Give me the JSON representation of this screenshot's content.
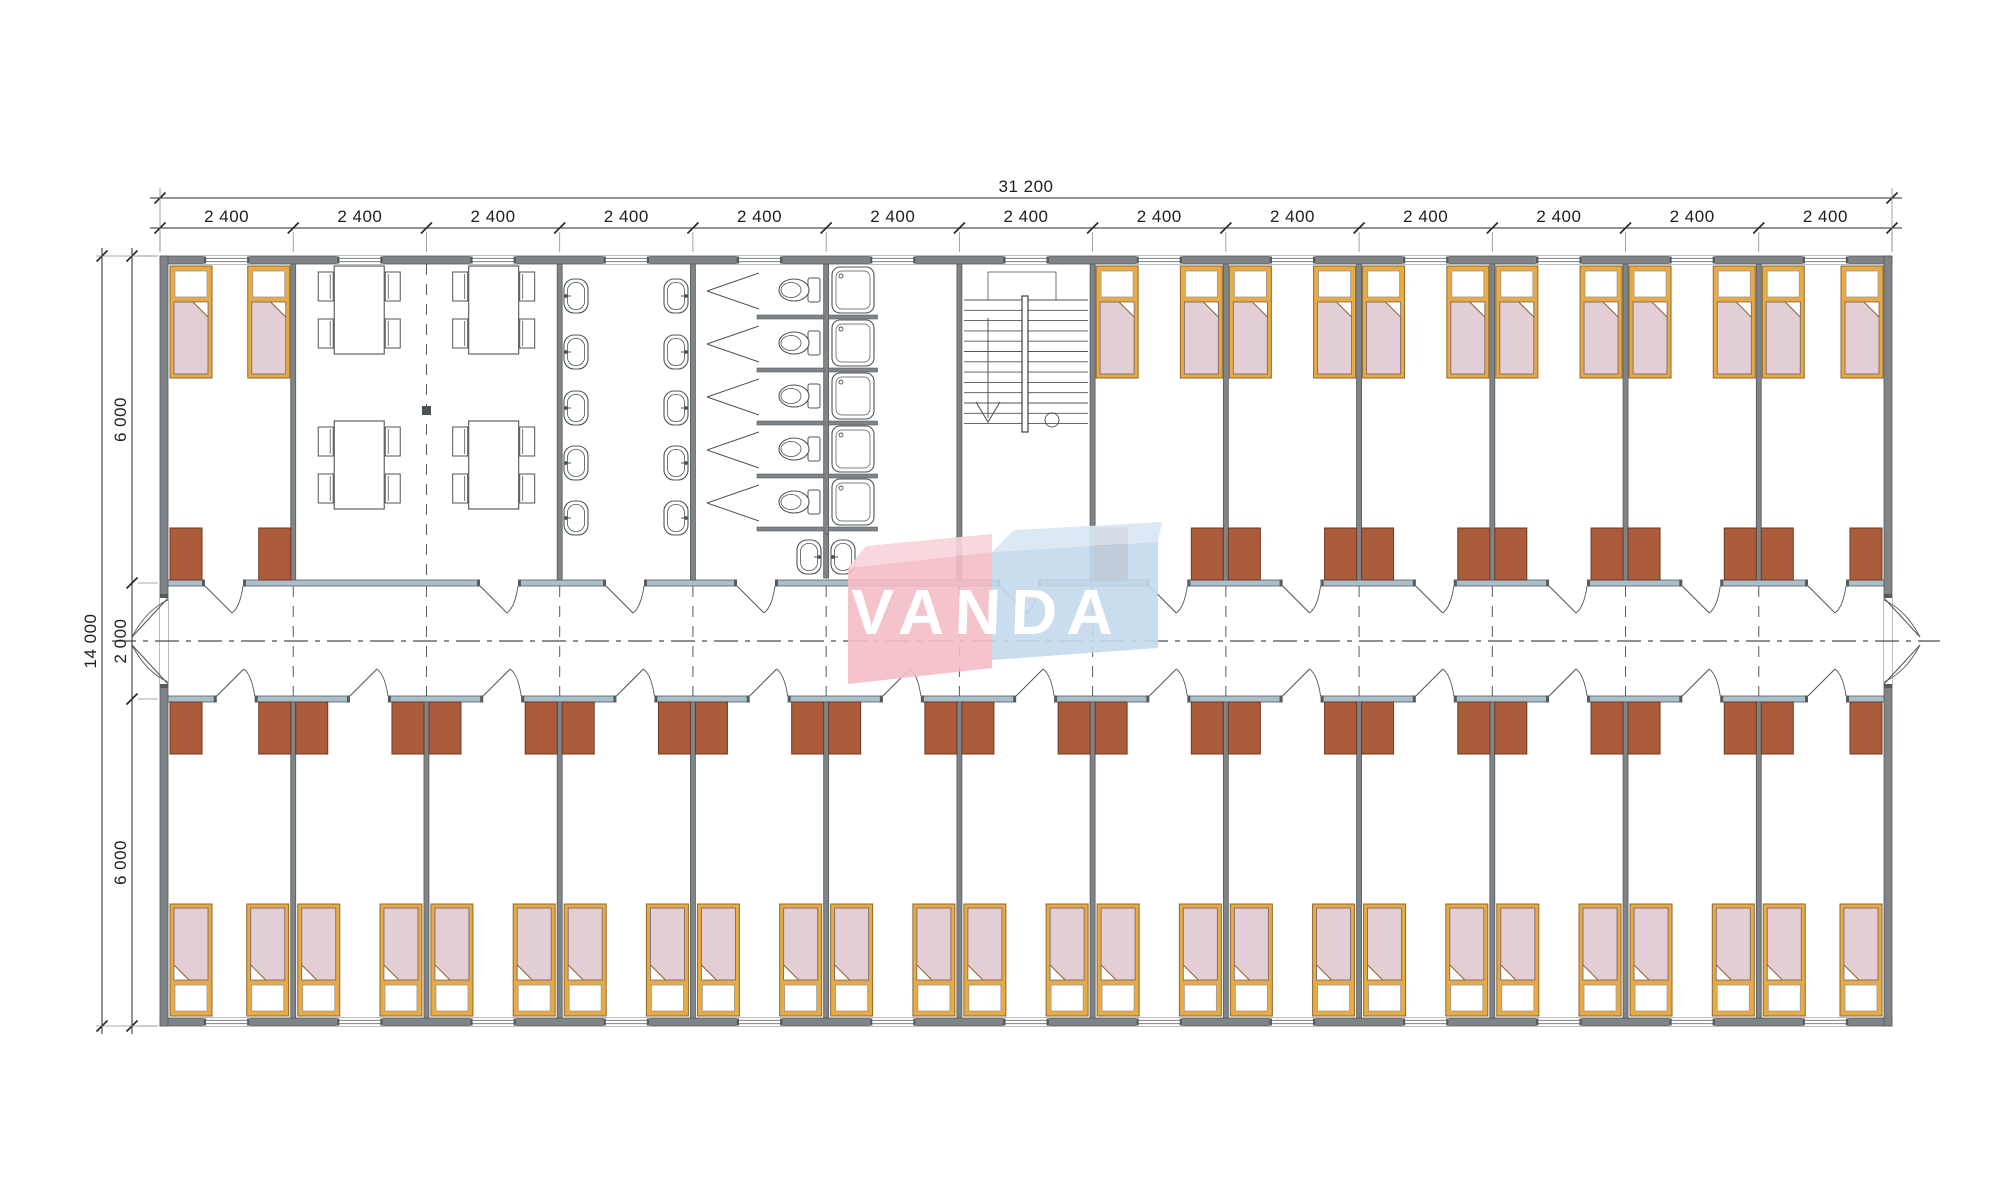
{
  "drawing": {
    "brand": {
      "text": "VANDA"
    },
    "dimensions": {
      "top_total": "31 200",
      "bays": [
        "2 400",
        "2 400",
        "2 400",
        "2 400",
        "2 400",
        "2 400",
        "2 400",
        "2 400",
        "2 400",
        "2 400",
        "2 400",
        "2 400",
        "2 400"
      ],
      "left_total": "14 000",
      "left_segments": [
        "6 000",
        "2 000",
        "6 000"
      ]
    },
    "colors": {
      "wall": "#7f8488",
      "wall_dark": "#565b5e",
      "wall_light": "#a9bfca",
      "line": "#555a5d",
      "fixture_line": "#4f5457",
      "bed_frame": "#e9aa43",
      "bed_frame_dark": "#8a6a33",
      "bed_fill": "#e2ced4",
      "bed_fill_dark": "#7a6a70",
      "pillow": "#ffffff",
      "wardrobe": "#ac5c3b",
      "wardrobe_dark": "#6c3a22",
      "dim": "#2a2a2a",
      "extension": "#8a8f92",
      "brand_pink": "#f4bcc7",
      "brand_pink_light": "#f7d4da",
      "brand_blue": "#c3d9ec",
      "brand_blue_light": "#d9e7f4",
      "brand_text_color": "#ffffff"
    }
  },
  "plan": {
    "modules": 13,
    "top_rooms": [
      "bedroom",
      "dining",
      "washroom",
      "toilets-showers",
      "staircase",
      "bedroom",
      "bedroom",
      "bedroom",
      "bedroom",
      "bedroom",
      "bedroom"
    ],
    "bottom_rooms": "13 bedrooms with two beds each",
    "corridor": "central corridor with doors to every room and exits at both ends"
  }
}
